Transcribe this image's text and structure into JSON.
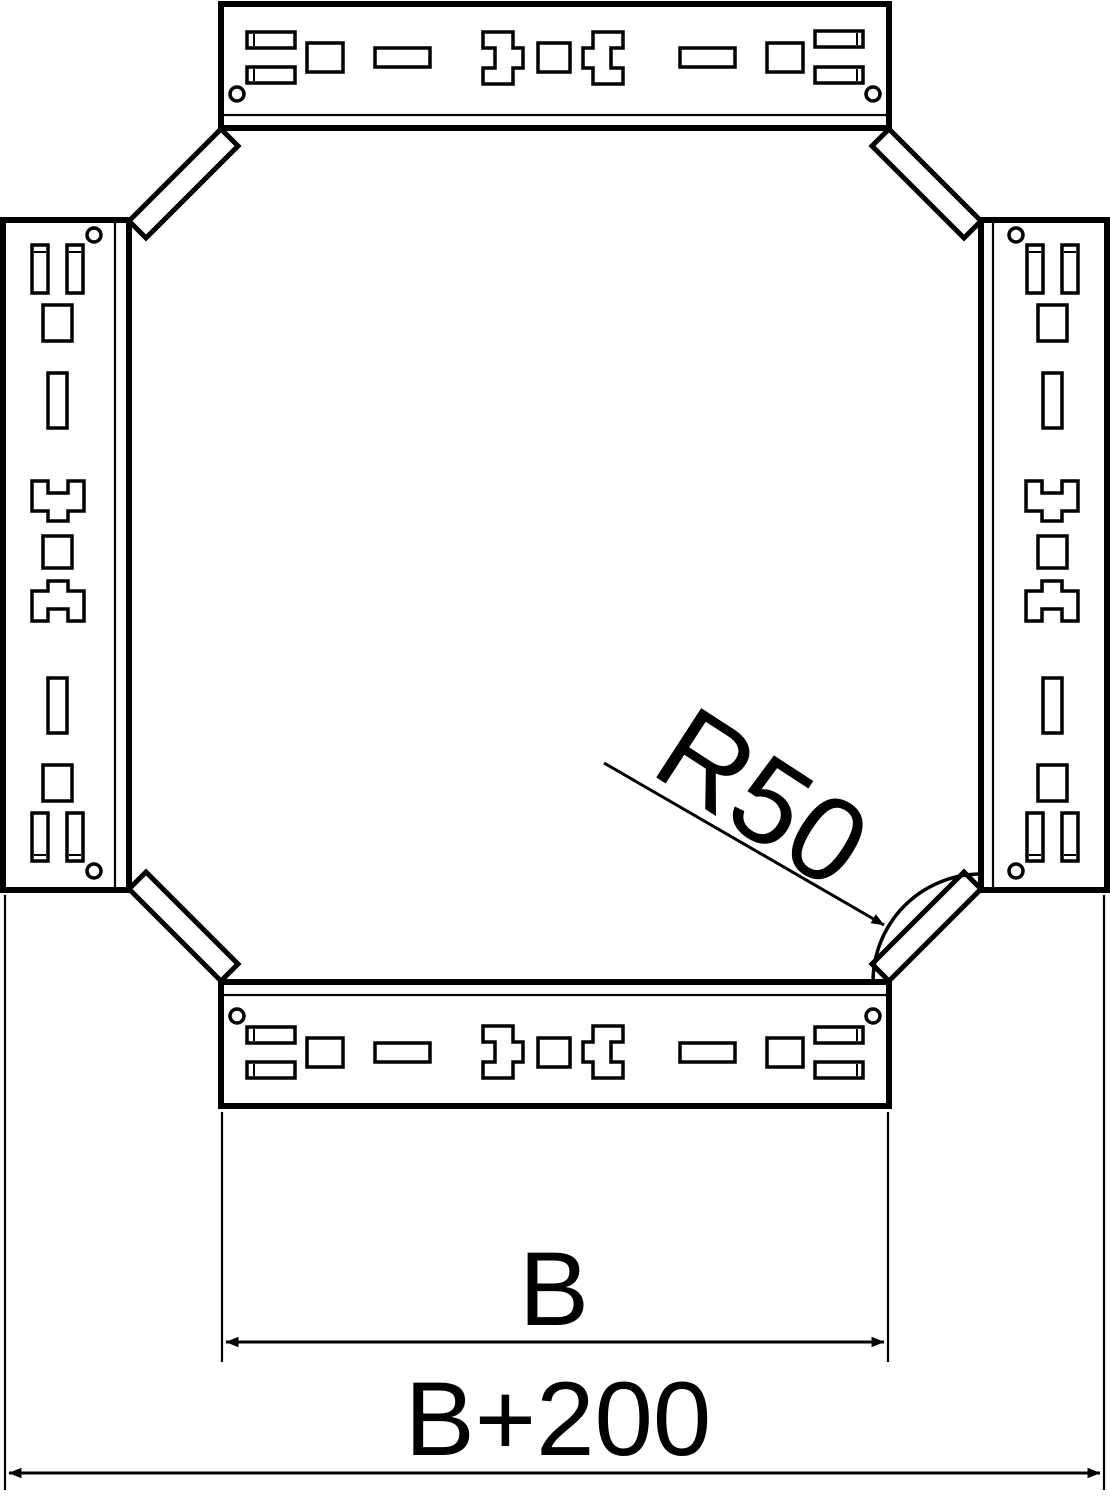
{
  "labels": {
    "radius": "R50",
    "width_b": "B",
    "width_b200": "B+200"
  },
  "colors": {
    "line": "#000000",
    "background": "#ffffff"
  }
}
